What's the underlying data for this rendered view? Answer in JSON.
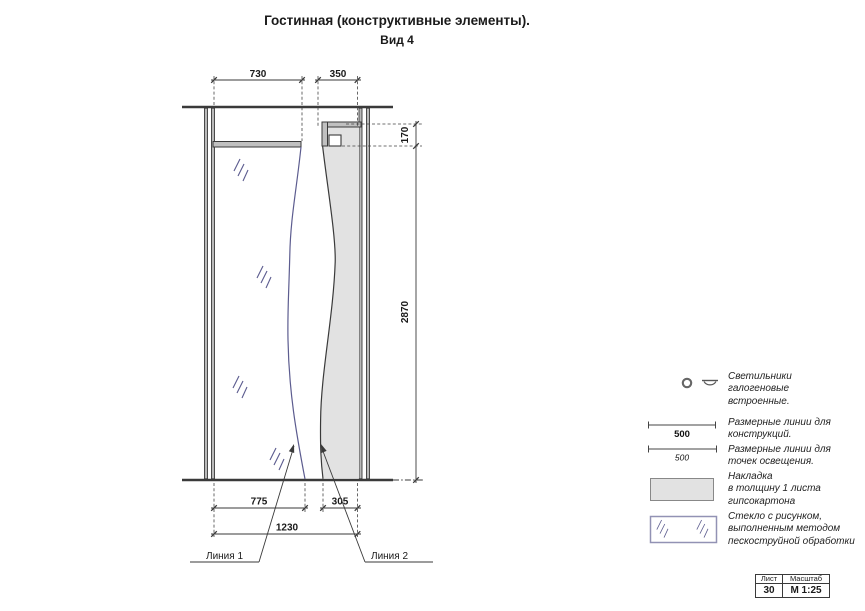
{
  "title": {
    "line1": "Гостинная (конструктивные элементы).",
    "line2": "Вид 4"
  },
  "drawing": {
    "dims": {
      "top_left": "730",
      "top_right": "350",
      "step": "170",
      "height": "2870",
      "bottom_left": "775",
      "bottom_right": "305",
      "total": "1230"
    },
    "labels": {
      "line1": "Линия 1",
      "line2": "Линия 2"
    }
  },
  "legend": {
    "items": [
      {
        "id": "halogen-lights",
        "lines": [
          "Светильники",
          "галогеновые",
          "встроенные."
        ]
      },
      {
        "id": "dim-lines-construction",
        "sample": "500",
        "lines": [
          "Размерные линии для",
          "конструкций."
        ]
      },
      {
        "id": "dim-lines-lighting",
        "sample": "500",
        "lines": [
          "Размерные линии для",
          "точек освещения."
        ]
      },
      {
        "id": "drywall-overlay",
        "lines": [
          "Накладка",
          "в толщину 1 листа",
          "гипсокартона"
        ]
      },
      {
        "id": "sandblasted-glass",
        "lines": [
          "Стекло с рисунком,",
          "выполненным методом",
          "пескоструйной обработки"
        ]
      }
    ]
  },
  "title_block": {
    "sheet_label": "Лист",
    "scale_label": "Масштаб",
    "sheet_value": "30",
    "scale_value": "М 1:25"
  },
  "colors": {
    "line": "#3a3a3a",
    "accent_blue": "#5c5c8f",
    "fill_grey": "#e2e2e2",
    "band_grey": "#c0c0c0"
  }
}
